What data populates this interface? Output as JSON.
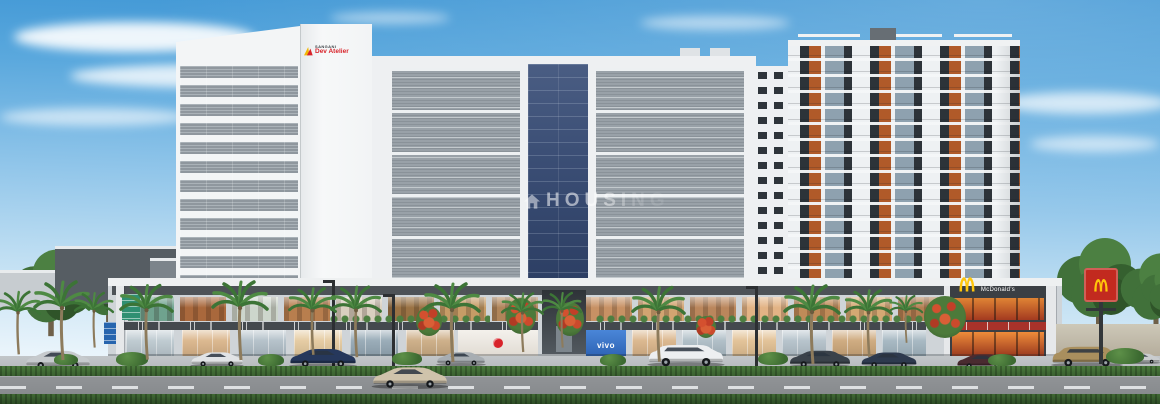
{
  "watermark": {
    "icon": "house-icon",
    "text": "HOUSING"
  },
  "developer_logo": {
    "brand_top": "SANGANI",
    "brand_name": "Dev Atelier"
  },
  "storefronts": {
    "mcdonalds_label": "McDonald's",
    "vivo_label": "vivo",
    "upper_left_tones": [
      "#6fa28e",
      "#a9683c",
      "#cdd6cc",
      "#b87e4e",
      "#d9cfbf",
      "#9a7244",
      "#c69c66",
      "#b0855a"
    ],
    "upper_right_tones": [
      "#c79164",
      "#d2a471",
      "#ba865c",
      "#e2b385",
      "#c08b58",
      "#d4a873",
      "#b37e52"
    ],
    "lower_left_tones": [
      "#b9c6cd",
      "#d8b184",
      "#aebcc5",
      "#e3c79a",
      "#90a4b1",
      "#c9a87e"
    ],
    "lower_right_tones": [
      "#d8b184",
      "#a9b9c2",
      "#e0bd8e",
      "#b0bec7",
      "#caa374",
      "#9fb2bd"
    ]
  },
  "colors": {
    "sky_top": "#3a93d3",
    "sky_horizon": "#f2f8fc",
    "tower_white": "#f3f5f6",
    "louver_gray": "#8f979e",
    "glass_blue": "#3a4d74",
    "residential_wood": "#b05a29",
    "residential_dark": "#2d3339",
    "fascia_dark": "#4d5257",
    "mcdonalds_red": "#c22a1f",
    "mcdonalds_yellow": "#ffc60a",
    "vodafone_red": "#d8232a",
    "vivo_blue": "#2f6fc2",
    "hedge_green": "#3e6a34",
    "road_gray": "#8b8e91"
  }
}
